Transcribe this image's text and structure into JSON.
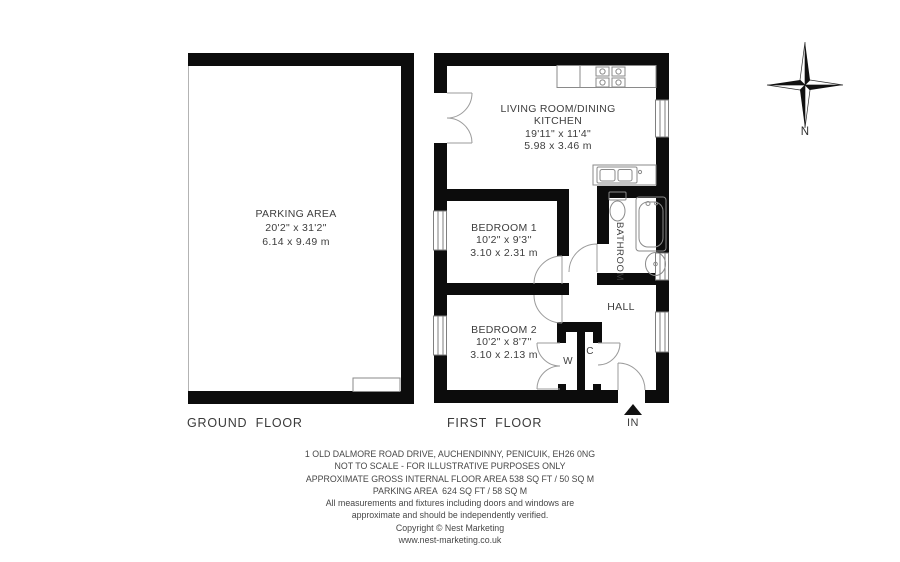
{
  "floorplan": {
    "ground_floor": {
      "title": "GROUND FLOOR",
      "parking": {
        "name": "PARKING AREA",
        "imperial": "20'2\" x 31'2\"",
        "metric": "6.14 x 9.49 m"
      }
    },
    "first_floor": {
      "title": "FIRST FLOOR",
      "living": {
        "name_line1": "LIVING ROOM/DINING",
        "name_line2": "KITCHEN",
        "imperial": "19'11\" x 11'4\"",
        "metric": "5.98 x 3.46 m"
      },
      "bedroom1": {
        "name": "BEDROOM 1",
        "imperial": "10'2\" x 9'3''",
        "metric": "3.10 x 2.31 m"
      },
      "bedroom2": {
        "name": "BEDROOM 2",
        "imperial": "10'2\" x 8'7''",
        "metric": "3.10 x 2.13 m"
      },
      "bathroom_label": "BATHROOM",
      "hall_label": "HALL",
      "wardrobe_label": "W",
      "cupboard_label": "C",
      "entrance_label": "IN"
    },
    "compass": {
      "north_label": "N"
    }
  },
  "footer": {
    "lines": [
      "1 OLD DALMORE ROAD DRIVE, AUCHENDINNY, PENICUIK, EH26 0NG",
      "NOT TO SCALE - FOR ILLUSTRATIVE PURPOSES ONLY",
      "APPROXIMATE GROSS INTERNAL FLOOR AREA 538 SQ FT / 50 SQ M",
      "PARKING AREA  624 SQ FT / 58 SQ M",
      "All measurements and fixtures including doors and windows are",
      "approximate and should be independently verified.",
      "Copyright © Nest Marketing",
      "www.nest-marketing.co.uk"
    ]
  }
}
